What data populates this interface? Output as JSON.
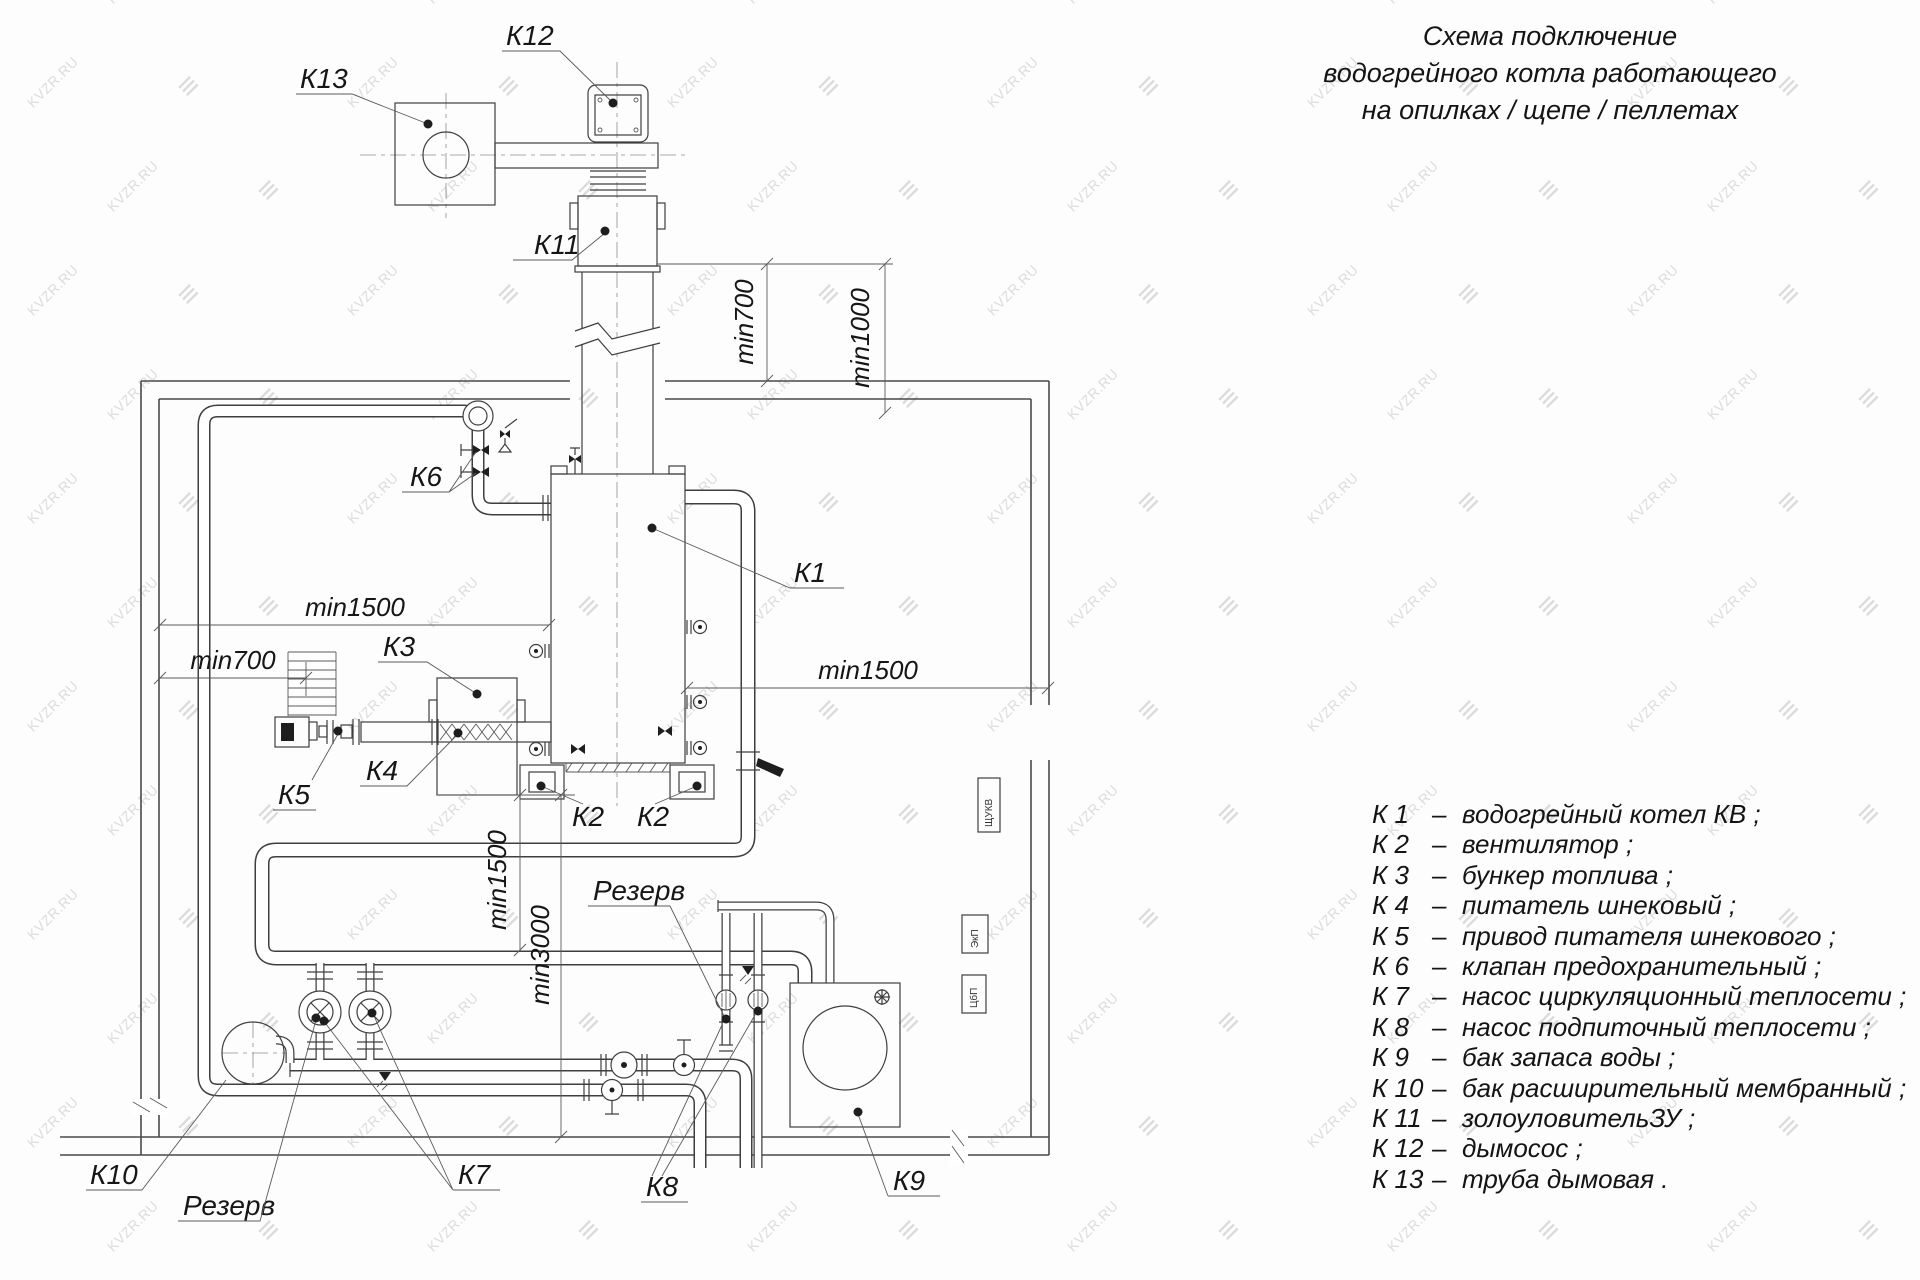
{
  "watermark": {
    "text": "KVZR.RU",
    "color": "#c6c6c6"
  },
  "title": {
    "lines": [
      "Схема подключение",
      "водогрейного котла работающего",
      "на опилках / щепе / пеллетах"
    ]
  },
  "legend": {
    "dash": "–",
    "items": [
      {
        "num": "К 1",
        "text": "водогрейный котел КВ ;"
      },
      {
        "num": "К 2",
        "text": "вентилятор ;"
      },
      {
        "num": "К 3",
        "text": "бункер топлива ;"
      },
      {
        "num": "К 4",
        "text": "питатель шнековый ;"
      },
      {
        "num": "К 5",
        "text": "привод питателя шнекового ;"
      },
      {
        "num": "К 6",
        "text": "клапан предохранительный ;"
      },
      {
        "num": "К 7",
        "text": "насос циркуляционный теплосети ;"
      },
      {
        "num": "К 8",
        "text": "насос подпиточный теплосети ;"
      },
      {
        "num": "К 9",
        "text": "бак запаса воды ;"
      },
      {
        "num": "К 10",
        "text": "бак расширительный мембранный ;"
      },
      {
        "num": "К 11",
        "text": "золоуловительЗУ ;"
      },
      {
        "num": "К 12",
        "text": "дымосос ;"
      },
      {
        "num": "К 13",
        "text": "труба дымовая ."
      }
    ]
  },
  "diagram": {
    "labels": {
      "k1": "К1",
      "k2": "К2",
      "k3": "К3",
      "k4": "К4",
      "k5": "К5",
      "k6": "К6",
      "k7": "К7",
      "k8": "К8",
      "k9": "К9",
      "k10": "К10",
      "k11": "К11",
      "k12": "К12",
      "k13": "К13",
      "reserve": "Резерв"
    },
    "dims": {
      "min700": "min700",
      "min1000": "min1000",
      "min1500": "min1500",
      "min3000": "min3000"
    },
    "panels": {
      "p1": "ЩУКВ",
      "p2": "ЭкП",
      "p3": "ЦбП"
    }
  }
}
